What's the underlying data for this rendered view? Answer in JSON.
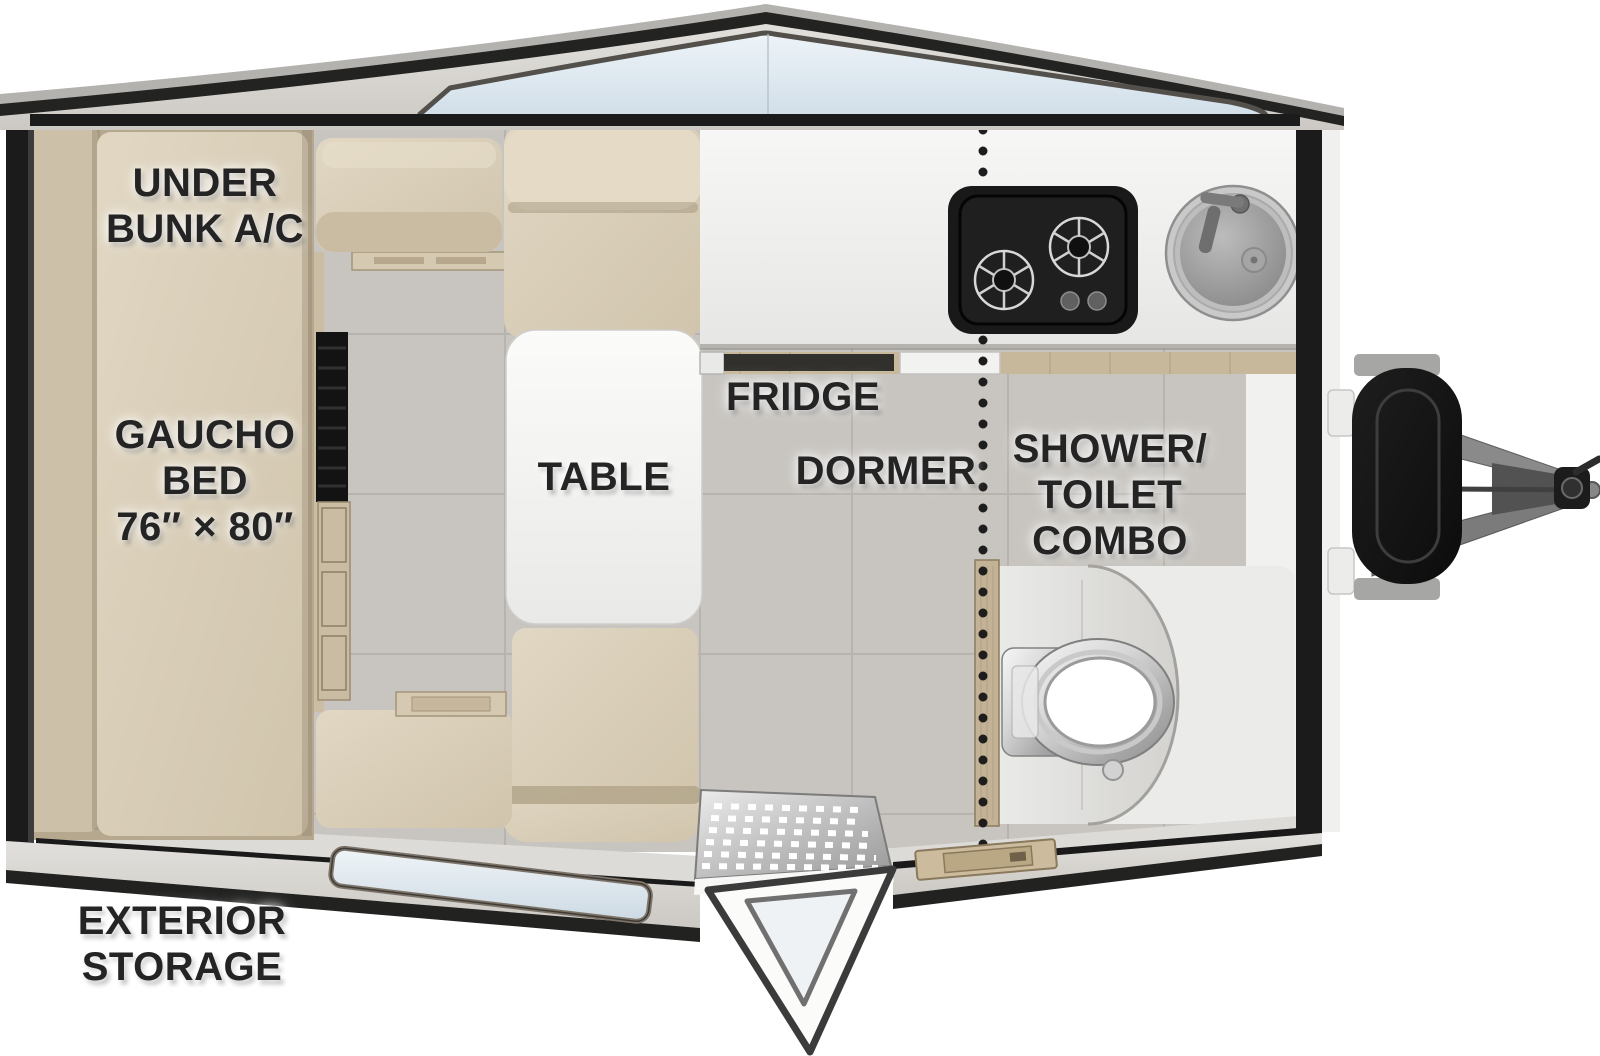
{
  "title": "A-frame travel trailer floor plan",
  "labels": {
    "under_bunk_ac": "UNDER\nBUNK A/C",
    "gaucho_bed": "GAUCHO\nBED\n76″ × 80″",
    "table": "TABLE",
    "fridge": "FRIDGE",
    "dormer": "DORMER",
    "shower_toilet_combo": "SHOWER/\nTOILET\nCOMBO",
    "exterior_storage": "EXTERIOR\nSTORAGE"
  },
  "fixtures": [
    "gaucho-bed",
    "dinette-table",
    "bench-seats",
    "kitchen-counter",
    "two-burner-cooktop",
    "round-sink",
    "fridge-vent",
    "dormer-divider-dotted-line",
    "shower-toilet-combo",
    "toilet",
    "shower-enclosure",
    "entry-door",
    "entry-step-mat",
    "floor-hatch",
    "front-window",
    "storage-window",
    "propane-tank",
    "a-frame-hitch",
    "wheel-less-tongue-jack"
  ],
  "colors": {
    "wall": "#1b1b1b",
    "roof_edge": "#232322",
    "roof_face": "#d8d6d2",
    "window_glass": "#dde9f1",
    "cushion_beige": "#d9cfba",
    "mattress_beige": "#dcd2bd",
    "tile_floor": "#c8c5c0",
    "bath_floor": "#ebebe9",
    "counter": "#f4f4f3",
    "wood_trim": "#c8b89b",
    "appliance_black": "#191919",
    "chrome": "#c6c6c6",
    "label_text": "#242424"
  }
}
